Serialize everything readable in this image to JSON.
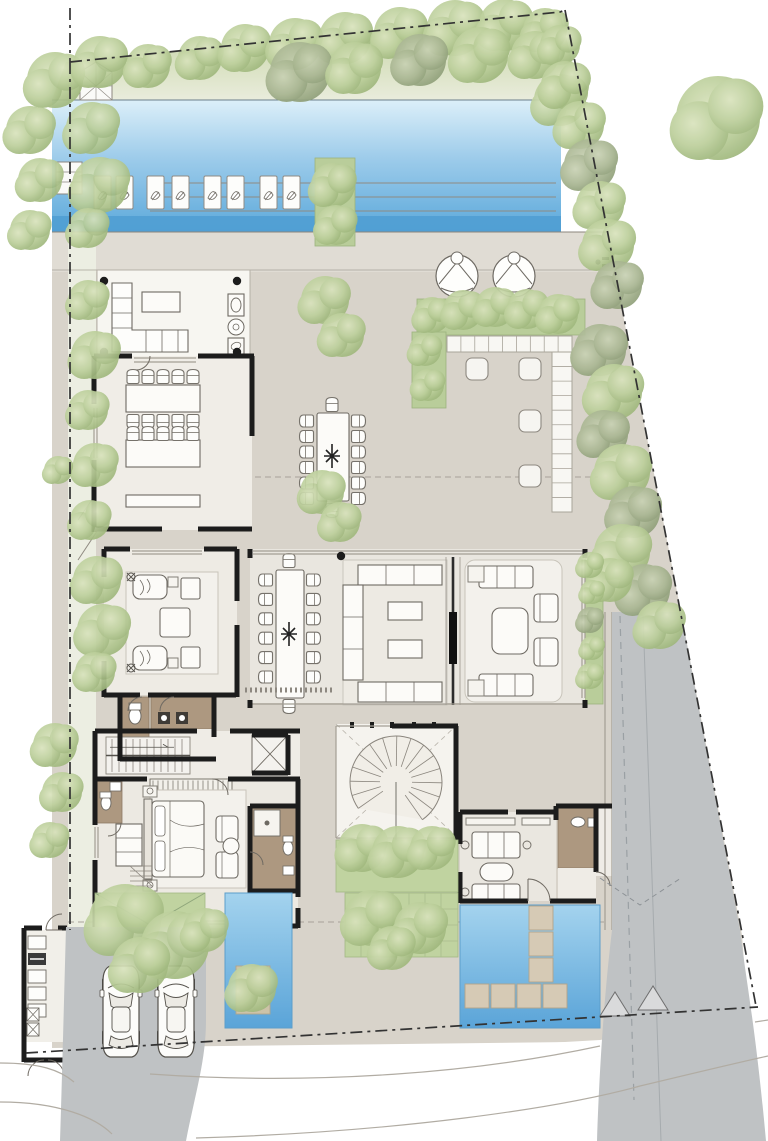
{
  "document": {
    "type": "architectural-site-plan",
    "level": "ground-floor",
    "visible_text": []
  },
  "palette": {
    "wall": "#1c1c1c",
    "terrace": "#d8d3ca",
    "deck": "#e0dcd4",
    "indoor": "#eae7e0",
    "room_light": "#f1eee8",
    "pool_top": "#d8ecf7",
    "pool_mid": "#79bbe4",
    "pool_deep": "#4f9dd2",
    "pond_top": "#9fd0ec",
    "pond_deep": "#5ea7da",
    "lawn": "#c6d5a8",
    "tree_light": "#bccf9b",
    "tree_dark": "#a8b591",
    "driveway": "#bfc2c4",
    "bath_floor": "#ad9880",
    "stepping_stone": "#d6cab5",
    "boundary_line": "#333333"
  },
  "inventory": {
    "sun_loungers": 8,
    "round_lounge_chairs": 2,
    "outdoor_dining_seats": 14,
    "indoor_dining_seats": 14,
    "long_tables": 2,
    "parked_cars": 2,
    "water_features": 3,
    "straight_stairs": 2,
    "spiral_stairs": 1,
    "elevators": 1,
    "ottoman_stools": 4
  },
  "trees": [
    [
      200,
      58,
      22,
      0
    ],
    [
      245,
      48,
      24,
      0
    ],
    [
      295,
      44,
      26,
      0
    ],
    [
      345,
      38,
      26,
      0
    ],
    [
      400,
      33,
      26,
      0
    ],
    [
      455,
      28,
      28,
      0
    ],
    [
      505,
      25,
      26,
      0
    ],
    [
      545,
      30,
      22,
      0
    ],
    [
      300,
      72,
      30,
      1
    ],
    [
      355,
      68,
      26,
      0
    ],
    [
      420,
      60,
      26,
      1
    ],
    [
      480,
      55,
      28,
      0
    ],
    [
      535,
      55,
      24,
      0
    ],
    [
      560,
      45,
      20,
      0
    ],
    [
      560,
      100,
      26,
      0
    ],
    [
      565,
      85,
      24,
      0
    ],
    [
      580,
      125,
      24,
      0
    ],
    [
      590,
      165,
      26,
      1
    ],
    [
      600,
      205,
      24,
      0
    ],
    [
      608,
      245,
      26,
      0
    ],
    [
      618,
      285,
      24,
      1
    ],
    [
      718,
      118,
      42,
      0
    ],
    [
      55,
      80,
      28,
      0
    ],
    [
      100,
      62,
      26,
      0
    ],
    [
      148,
      66,
      22,
      0
    ],
    [
      30,
      130,
      24,
      0
    ],
    [
      40,
      180,
      22,
      0
    ],
    [
      30,
      230,
      20,
      0
    ],
    [
      92,
      128,
      26,
      0
    ],
    [
      100,
      185,
      28,
      0
    ],
    [
      88,
      228,
      20,
      0
    ],
    [
      88,
      300,
      20,
      0
    ],
    [
      95,
      355,
      24,
      0
    ],
    [
      88,
      410,
      20,
      0
    ],
    [
      95,
      465,
      22,
      0
    ],
    [
      90,
      520,
      20,
      0
    ],
    [
      58,
      470,
      14,
      0
    ],
    [
      97,
      580,
      24,
      0
    ],
    [
      103,
      630,
      26,
      0
    ],
    [
      95,
      672,
      20,
      0
    ],
    [
      55,
      745,
      22,
      0
    ],
    [
      62,
      792,
      20,
      0
    ],
    [
      50,
      840,
      18,
      0
    ],
    [
      325,
      300,
      24,
      0
    ],
    [
      342,
      335,
      22,
      0
    ],
    [
      322,
      492,
      22,
      0
    ],
    [
      340,
      522,
      20,
      0
    ],
    [
      432,
      315,
      18,
      0
    ],
    [
      463,
      310,
      20,
      0
    ],
    [
      495,
      307,
      20,
      0
    ],
    [
      527,
      309,
      20,
      0
    ],
    [
      558,
      314,
      20,
      0
    ],
    [
      425,
      350,
      16,
      0
    ],
    [
      428,
      385,
      16,
      0
    ],
    [
      600,
      350,
      26,
      1
    ],
    [
      614,
      392,
      28,
      0
    ],
    [
      604,
      434,
      24,
      1
    ],
    [
      622,
      472,
      28,
      0
    ],
    [
      634,
      512,
      26,
      1
    ],
    [
      622,
      552,
      28,
      0
    ],
    [
      644,
      590,
      26,
      1
    ],
    [
      660,
      625,
      24,
      0
    ],
    [
      610,
      580,
      22,
      0
    ],
    [
      590,
      565,
      13,
      0
    ],
    [
      592,
      592,
      12,
      0
    ],
    [
      590,
      620,
      13,
      1
    ],
    [
      592,
      648,
      12,
      0
    ],
    [
      590,
      676,
      13,
      0
    ],
    [
      125,
      920,
      36,
      0
    ],
    [
      175,
      945,
      34,
      0
    ],
    [
      140,
      965,
      28,
      0
    ],
    [
      205,
      930,
      22,
      0
    ],
    [
      362,
      848,
      24,
      0
    ],
    [
      398,
      852,
      26,
      0
    ],
    [
      432,
      848,
      22,
      0
    ],
    [
      372,
      918,
      28,
      0
    ],
    [
      420,
      928,
      26,
      0
    ],
    [
      392,
      948,
      22,
      0
    ],
    [
      252,
      988,
      24,
      0
    ],
    [
      333,
      185,
      22,
      0
    ],
    [
      336,
      225,
      20,
      0
    ]
  ],
  "sun_loungers_xy": [
    [
      94,
      176
    ],
    [
      116,
      176
    ],
    [
      147,
      176
    ],
    [
      172,
      176
    ],
    [
      204,
      176
    ],
    [
      227,
      176
    ],
    [
      260,
      176
    ],
    [
      283,
      176
    ]
  ],
  "chair_rows": [
    {
      "x": 133,
      "y": 377,
      "dx": 15,
      "dy": 0,
      "n": 5,
      "rot": 0
    },
    {
      "x": 133,
      "y": 421,
      "dx": 15,
      "dy": 0,
      "n": 5,
      "rot": 180
    },
    {
      "x": 133,
      "y": 434,
      "dx": 15,
      "dy": 0,
      "n": 5,
      "rot": 0
    },
    {
      "x": 307,
      "y": 421,
      "dx": 0,
      "dy": 15.5,
      "n": 6,
      "rot": 270
    },
    {
      "x": 358,
      "y": 421,
      "dx": 0,
      "dy": 15.5,
      "n": 6,
      "rot": 90
    },
    {
      "x": 332,
      "y": 405,
      "dx": 0,
      "dy": 0,
      "n": 1,
      "rot": 0
    },
    {
      "x": 332,
      "y": 510,
      "dx": 0,
      "dy": 0,
      "n": 1,
      "rot": 180
    },
    {
      "x": 266,
      "y": 580,
      "dx": 0,
      "dy": 19.4,
      "n": 6,
      "rot": 270
    },
    {
      "x": 313,
      "y": 580,
      "dx": 0,
      "dy": 19.4,
      "n": 6,
      "rot": 90
    },
    {
      "x": 289,
      "y": 561,
      "dx": 0,
      "dy": 0,
      "n": 1,
      "rot": 0
    },
    {
      "x": 289,
      "y": 706,
      "dx": 0,
      "dy": 0,
      "n": 1,
      "rot": 180
    }
  ],
  "stepping_stones": [
    [
      529,
      906
    ],
    [
      529,
      932
    ],
    [
      529,
      958
    ],
    [
      465,
      984
    ],
    [
      491,
      984
    ],
    [
      517,
      984
    ],
    [
      543,
      984
    ]
  ],
  "cars_xy": [
    [
      104,
      966
    ],
    [
      159,
      966
    ]
  ],
  "benches": [
    {
      "x": 447,
      "y": 336,
      "w": 125,
      "h": 16,
      "cells": 9,
      "vertical": false
    },
    {
      "x": 552,
      "y": 352,
      "w": 20,
      "h": 160,
      "cells": 11,
      "vertical": true
    }
  ],
  "stools_xy": [
    [
      466,
      358
    ],
    [
      519,
      358
    ],
    [
      519,
      410
    ],
    [
      519,
      465
    ]
  ],
  "wardrobe": {
    "x": 150,
    "y": 779,
    "w": 82,
    "h": 12,
    "step": 5
  },
  "main_stair": {
    "x": 108,
    "y": 739,
    "w": 80,
    "h": 33,
    "tread": 7
  },
  "spiral_stair": {
    "cx": 396,
    "cy": 782,
    "r_inner": 16,
    "r_outer": 46,
    "start_deg": -215,
    "end_deg": 55,
    "treads": 15
  },
  "utility_shelves": [
    [
      28,
      936
    ],
    [
      28,
      970
    ],
    [
      28,
      987
    ],
    [
      28,
      1004
    ]
  ],
  "utility_dark_unit": [
    28,
    953
  ],
  "utility_machines": [
    [
      27,
      1008
    ],
    [
      27,
      1023
    ]
  ]
}
